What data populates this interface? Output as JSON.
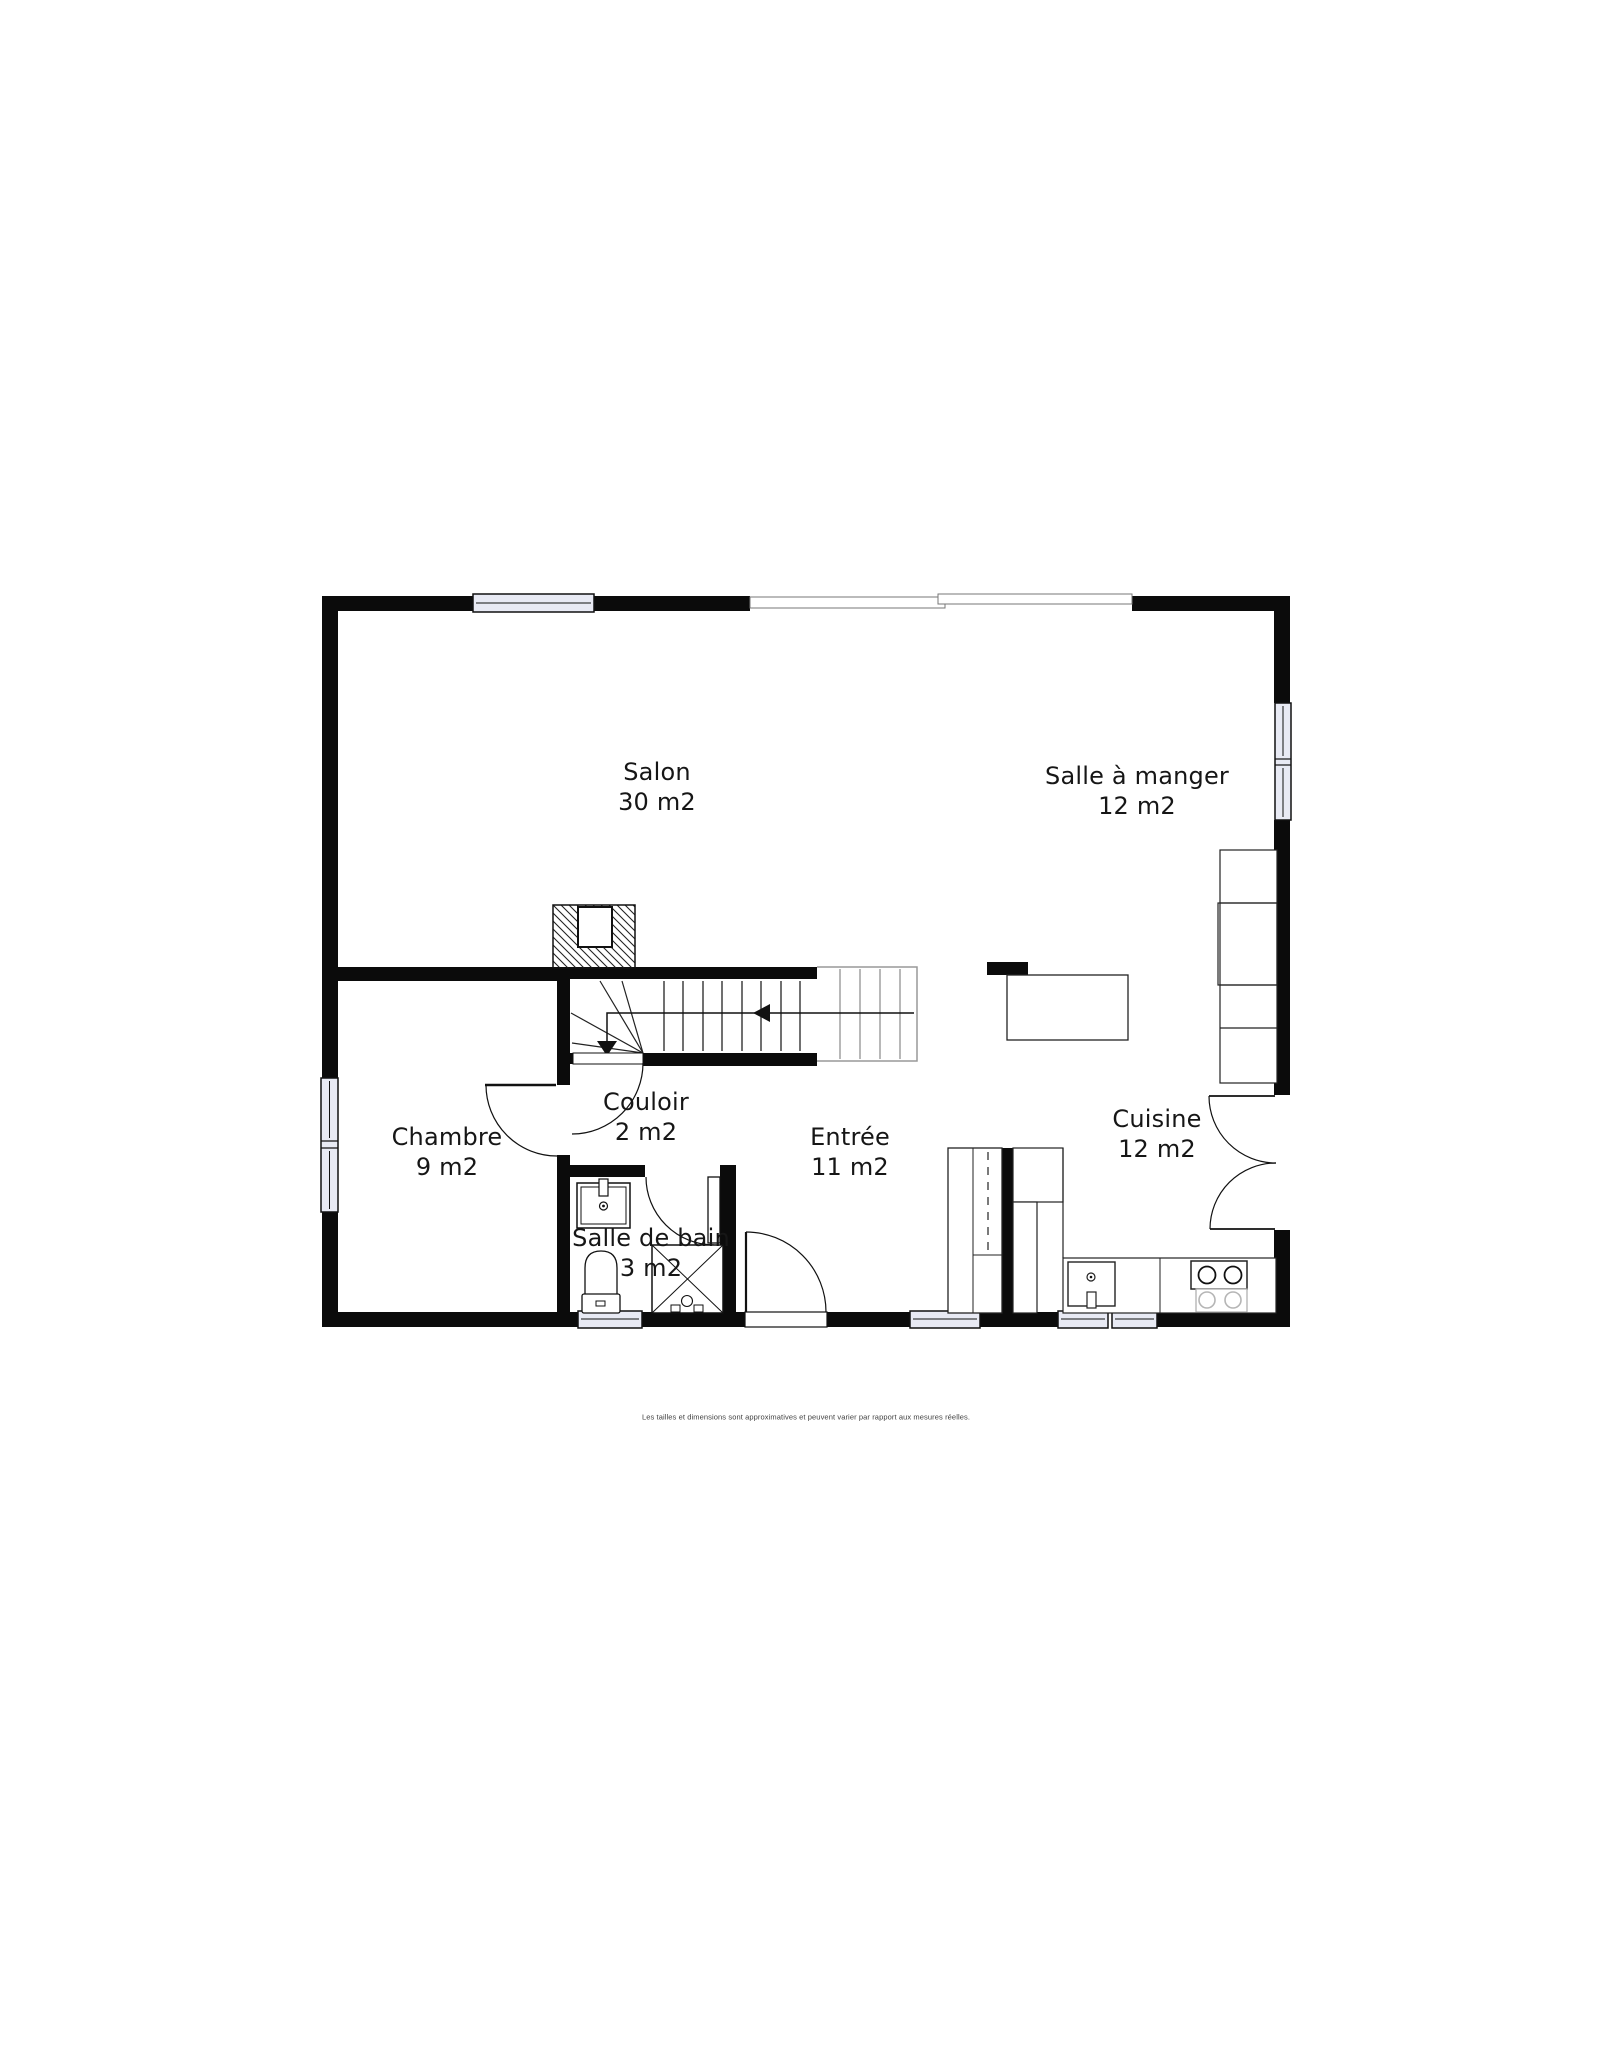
{
  "plan": {
    "rooms": [
      {
        "id": "salon",
        "name": "Salon",
        "area": "30 m2"
      },
      {
        "id": "salle-a-manger",
        "name": "Salle à manger",
        "area": "12 m2"
      },
      {
        "id": "chambre",
        "name": "Chambre",
        "area": "9 m2"
      },
      {
        "id": "couloir",
        "name": "Couloir",
        "area": "2 m2"
      },
      {
        "id": "entree",
        "name": "Entrée",
        "area": "11 m2"
      },
      {
        "id": "cuisine",
        "name": "Cuisine",
        "area": "12 m2"
      },
      {
        "id": "salle-de-bain",
        "name": "Salle de bain",
        "area": "3 m2"
      }
    ],
    "disclaimer": "Les tailles et dimensions sont approximatives et peuvent varier par rapport aux mesures réelles.",
    "colors": {
      "wall": "#0b0b0b",
      "window_pane": "#e8eaf4",
      "background": "#ffffff",
      "light_lines": "#888888"
    }
  }
}
